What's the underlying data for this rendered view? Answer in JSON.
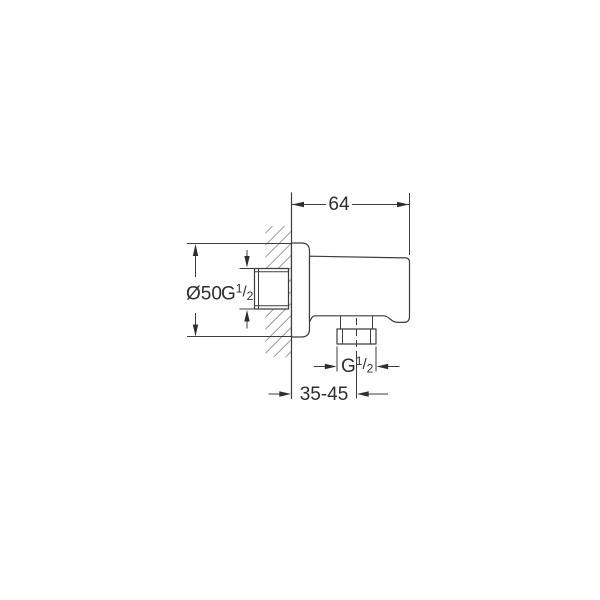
{
  "drawing": {
    "dimensions": {
      "projection_width": "64",
      "flange_diameter": "Ø50",
      "wall_connection_thread": {
        "prefix": "G",
        "numerator": "1",
        "slash": "/",
        "denominator": "2"
      },
      "outlet_thread": {
        "prefix": "G",
        "numerator": "1",
        "slash": "/",
        "denominator": "2"
      },
      "wall_to_outlet_distance": "35-45"
    },
    "colors": {
      "line": "#3d3d3d",
      "hatch": "#9b9b9b",
      "text": "#2e2e2e",
      "background": "#ffffff"
    }
  }
}
